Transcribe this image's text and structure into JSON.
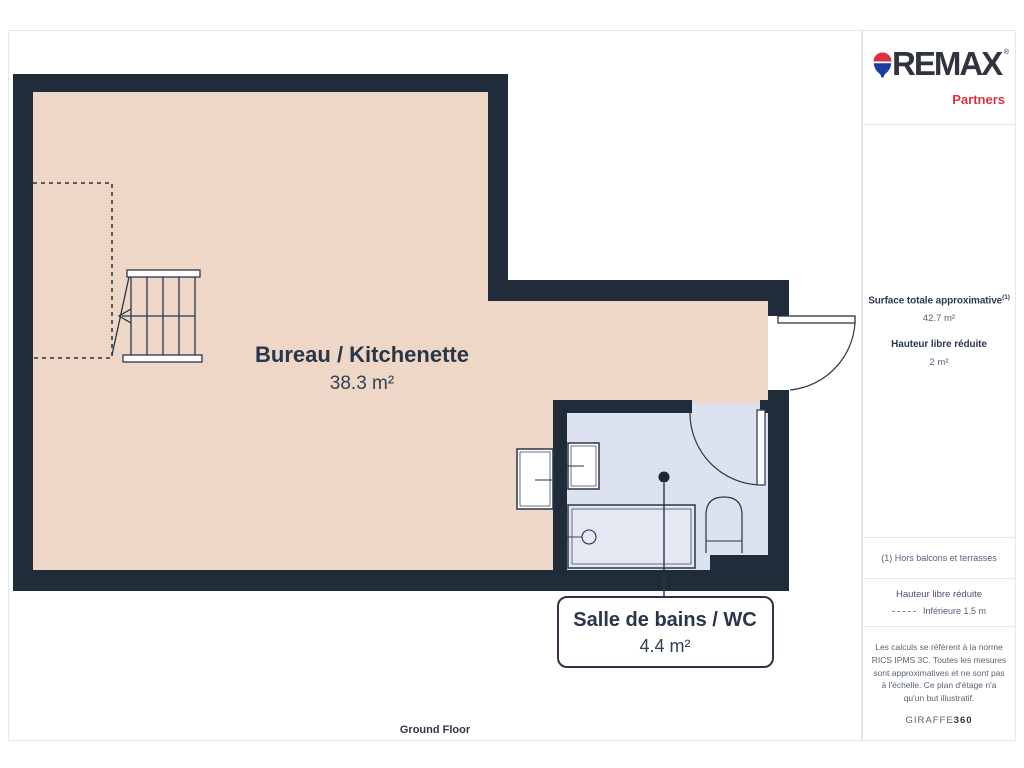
{
  "page": {
    "floor_label": "Ground Floor"
  },
  "plan": {
    "rooms": [
      {
        "name": "Bureau / Kitchenette",
        "area": "38.3 m²"
      },
      {
        "name": "Salle de bains / WC",
        "area": "4.4 m²"
      }
    ]
  },
  "sidebar": {
    "brand": {
      "name": "REMAX",
      "mark": "®",
      "sub": "Partners"
    },
    "stats": {
      "surface_label": "Surface totale approximative",
      "surface_footnote_marker": "(1)",
      "surface_value": "42.7 m²",
      "height_label": "Hauteur libre réduite",
      "height_value": "2 m²"
    },
    "footnote": "(1) Hors balcons et terrasses",
    "legend": {
      "title": "Hauteur libre réduite",
      "item": "Inférieure 1.5 m"
    },
    "legal": "Les calculs se réfèrent à la norme RICS IPMS 3C. Toutes les mesures sont approximatives et ne sont pas à l'échelle. Ce plan d'étage n'a qu'un but illustratif.",
    "provider": {
      "name": "GIRAFFE",
      "suffix": "360"
    }
  },
  "colors": {
    "wall": "#212c3b",
    "room_fill": "#eed7c6",
    "bathroom_fill": "#dde2f0",
    "line": "#2a3648",
    "brand_red": "#d8333f",
    "brand_navy": "#30343e",
    "balloon_blue": "#1d3da0",
    "panel_border": "#e7e7e7"
  }
}
